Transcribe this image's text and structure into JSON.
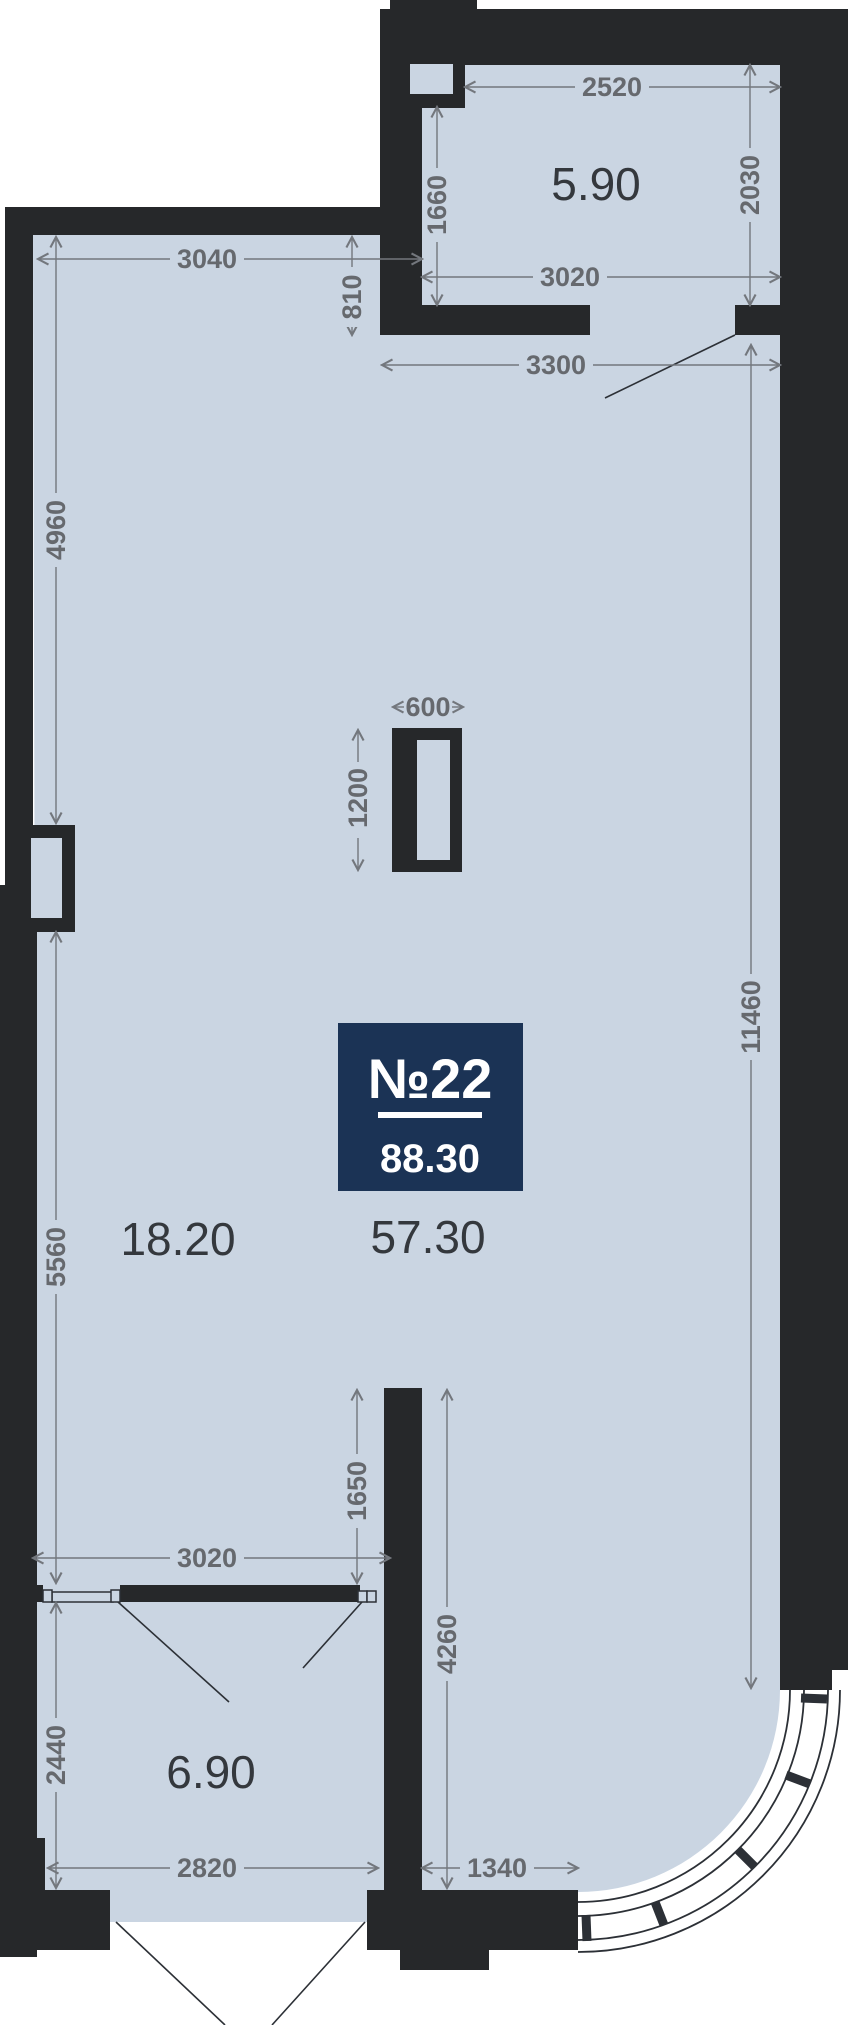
{
  "plan": {
    "unit_badge": {
      "number": "№22",
      "total_area": "88.30"
    },
    "rooms": [
      {
        "id": "room-top",
        "area_label": "5.90"
      },
      {
        "id": "room-left",
        "area_label": "18.20"
      },
      {
        "id": "room-main",
        "area_label": "57.30"
      },
      {
        "id": "room-bottom",
        "area_label": "6.90"
      }
    ],
    "dimensions_mm": {
      "d3040": "3040",
      "d2520": "2520",
      "d2030": "2030",
      "d1660": "1660",
      "d3020_top": "3020",
      "d810": "810",
      "d3300": "3300",
      "d4960": "4960",
      "d600": "600",
      "d1200": "1200",
      "d11460": "11460",
      "d5560": "5560",
      "d1650": "1650",
      "d3020_bottom": "3020",
      "d2440": "2440",
      "d2820": "2820",
      "d1340": "1340",
      "d4260": "4260"
    },
    "colors": {
      "wall": "#26282a",
      "floor": "#cad5e2",
      "dimension": "#66696e",
      "room_label": "#34383d",
      "badge_background": "#1b3355",
      "badge_text": "#ffffff",
      "background": "#ffffff"
    }
  }
}
